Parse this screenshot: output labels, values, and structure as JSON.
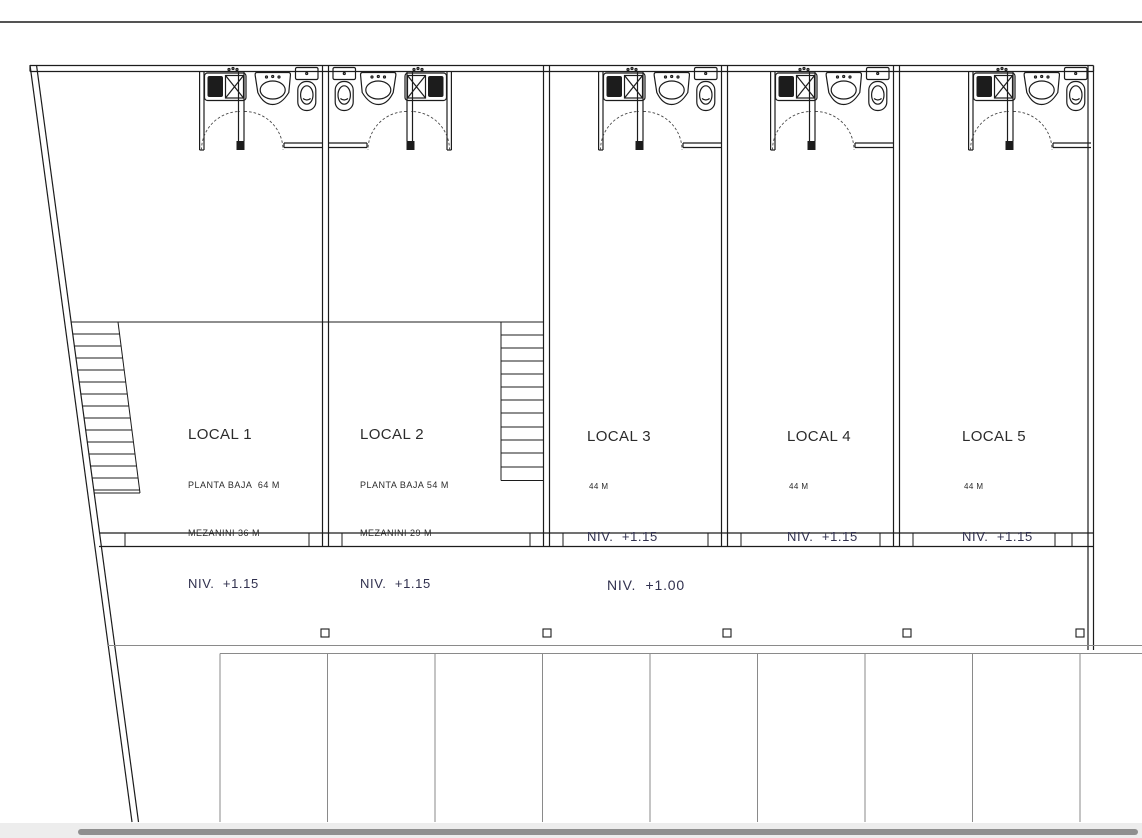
{
  "colors": {
    "wall": "#1c1c1c",
    "parkline": "#8a8a8a",
    "level_text": "#31314f",
    "label_text": "#2b2b2b",
    "scroll_track": "#ededed",
    "scroll_thumb": "#8f8f8f",
    "background": "#ffffff"
  },
  "plan": {
    "walkway_level": "NIV.  +1.00",
    "locals": [
      {
        "name": "LOCAL 1",
        "sub1": "PLANTA BAJA  64 M",
        "sub2": "MEZANINI 36 M",
        "level": "NIV.  +1.15"
      },
      {
        "name": "LOCAL 2",
        "sub1": "PLANTA BAJA 54 M",
        "sub2": "MEZANINI 29 M",
        "level": "NIV.  +1.15"
      },
      {
        "name": "LOCAL 3",
        "sub1": "44 M",
        "level": "NIV.  +1.15"
      },
      {
        "name": "LOCAL 4",
        "sub1": "44 M",
        "level": "NIV.  +1.15"
      },
      {
        "name": "LOCAL 5",
        "sub1": "44 M",
        "level": "NIV.  +1.15"
      }
    ]
  }
}
